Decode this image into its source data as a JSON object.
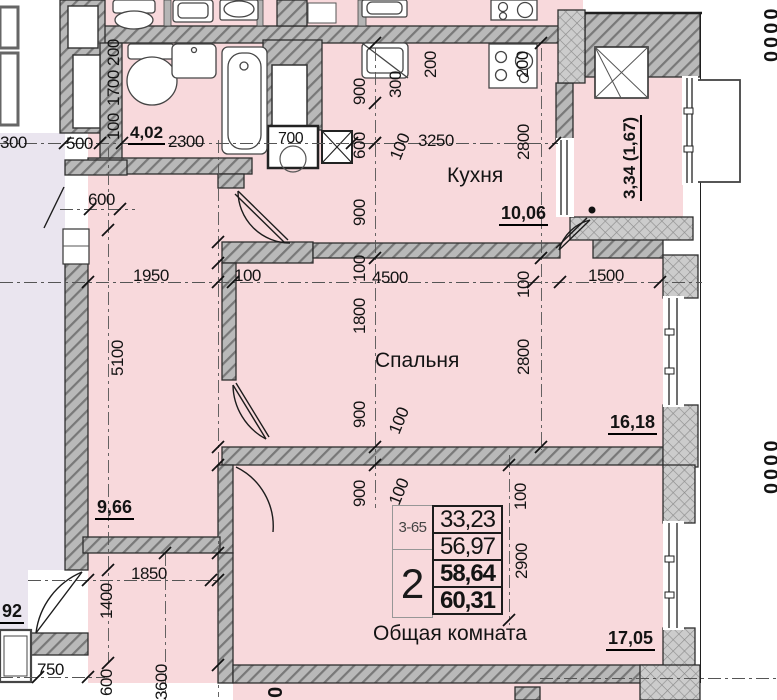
{
  "colors": {
    "room_fill": "#f8d9dc",
    "neighbor_fill": "#eae5ef",
    "wall_gray": "#b9b9b9",
    "wall_stroke": "#2e2e2e"
  },
  "labels": {
    "kitchen": "Кухня",
    "kitchen_area": "10,06",
    "bedroom": "Спальня",
    "bedroom_area": "16,18",
    "living": "Общая комната",
    "living_area": "17,05",
    "bath_area": "4,02",
    "hall_area": "9,66",
    "balcony_area": "3,34 (1,67)",
    "neighbor_area": "92",
    "shaft": "700"
  },
  "stamp": {
    "unit": "3-65",
    "rooms": "2",
    "areas": [
      "33,23",
      "56,97",
      "58,64",
      "60,31"
    ]
  },
  "dims": {
    "d300": "300",
    "d500": "500",
    "d2300": "2300",
    "d3250": "3250",
    "d600top": "600",
    "d1950": "1950",
    "d100a": "100",
    "d4500": "4500",
    "d1500": "1500",
    "d1850": "1850",
    "d750": "750",
    "v200a": "200",
    "v1700": "1700",
    "v100a": "100",
    "v900a": "900",
    "v600a": "600",
    "v300a": "300",
    "v100b": "100",
    "v200b": "200",
    "v200c": "200",
    "v2800a": "2800",
    "v900b": "900",
    "v100c": "100",
    "v1800": "1800",
    "v5100": "5100",
    "v900c": "900",
    "v100d": "100",
    "v100e": "100",
    "v2800b": "2800",
    "v900d": "900",
    "v100f": "100",
    "v100g": "100",
    "v2900": "2900",
    "v1400": "1400",
    "v600b": "600",
    "v3600": "3600"
  },
  "edge": {
    "top": "0000",
    "mid": "0000",
    "bottom": "00"
  }
}
